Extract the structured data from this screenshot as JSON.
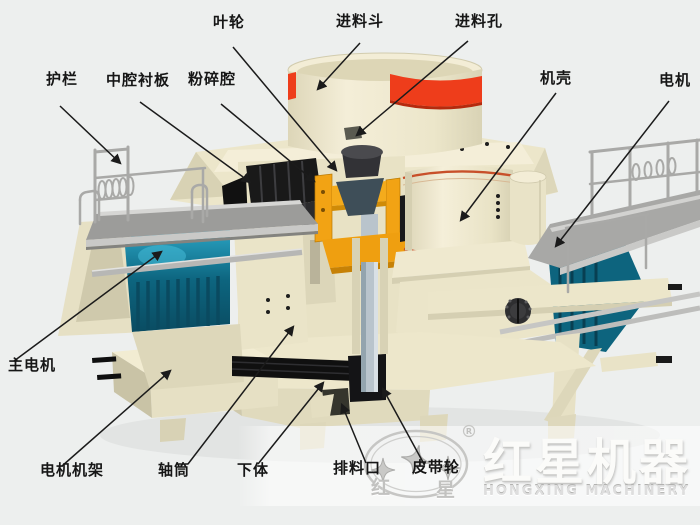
{
  "labels": {
    "hulan": {
      "text": "护栏"
    },
    "zhongqiangchenban": {
      "text": "中腔衬板"
    },
    "fensuiqiang": {
      "text": "粉碎腔"
    },
    "yelun": {
      "text": "叶轮"
    },
    "jinliaodou": {
      "text": "进料斗"
    },
    "jinliaokong": {
      "text": "进料孔"
    },
    "jike": {
      "text": "机壳"
    },
    "dianji": {
      "text": "电机"
    },
    "zhudianji": {
      "text": "主电机"
    },
    "dianjijijia": {
      "text": "电机机架"
    },
    "zhoutong": {
      "text": "轴筒"
    },
    "xiati": {
      "text": "下体"
    },
    "pailiaokou": {
      "text": "排料口"
    },
    "pidailun": {
      "text": "皮带轮"
    }
  },
  "watermark": {
    "brand_cn": "红星机器",
    "brand_en": "HONGXING MACHINERY",
    "registered_mark": "®",
    "char_left": "红",
    "char_right": "星"
  },
  "colors": {
    "background": "#edefee",
    "machine_cream": "#eee8cd",
    "machine_cream_shadow": "#d8d2b4",
    "hopper_red_band": "#ee3d1b",
    "drum_stripe_orange": "#c8502a",
    "impeller_orange": "#f2a314",
    "motor_teal": "#11708e",
    "liner_black": "#1c1c1c",
    "platform_gray": "#9c9c9a",
    "shaft_gray": "#b9c4cc",
    "label_text": "#161616",
    "watermark_gray": "#c6c6c4"
  }
}
